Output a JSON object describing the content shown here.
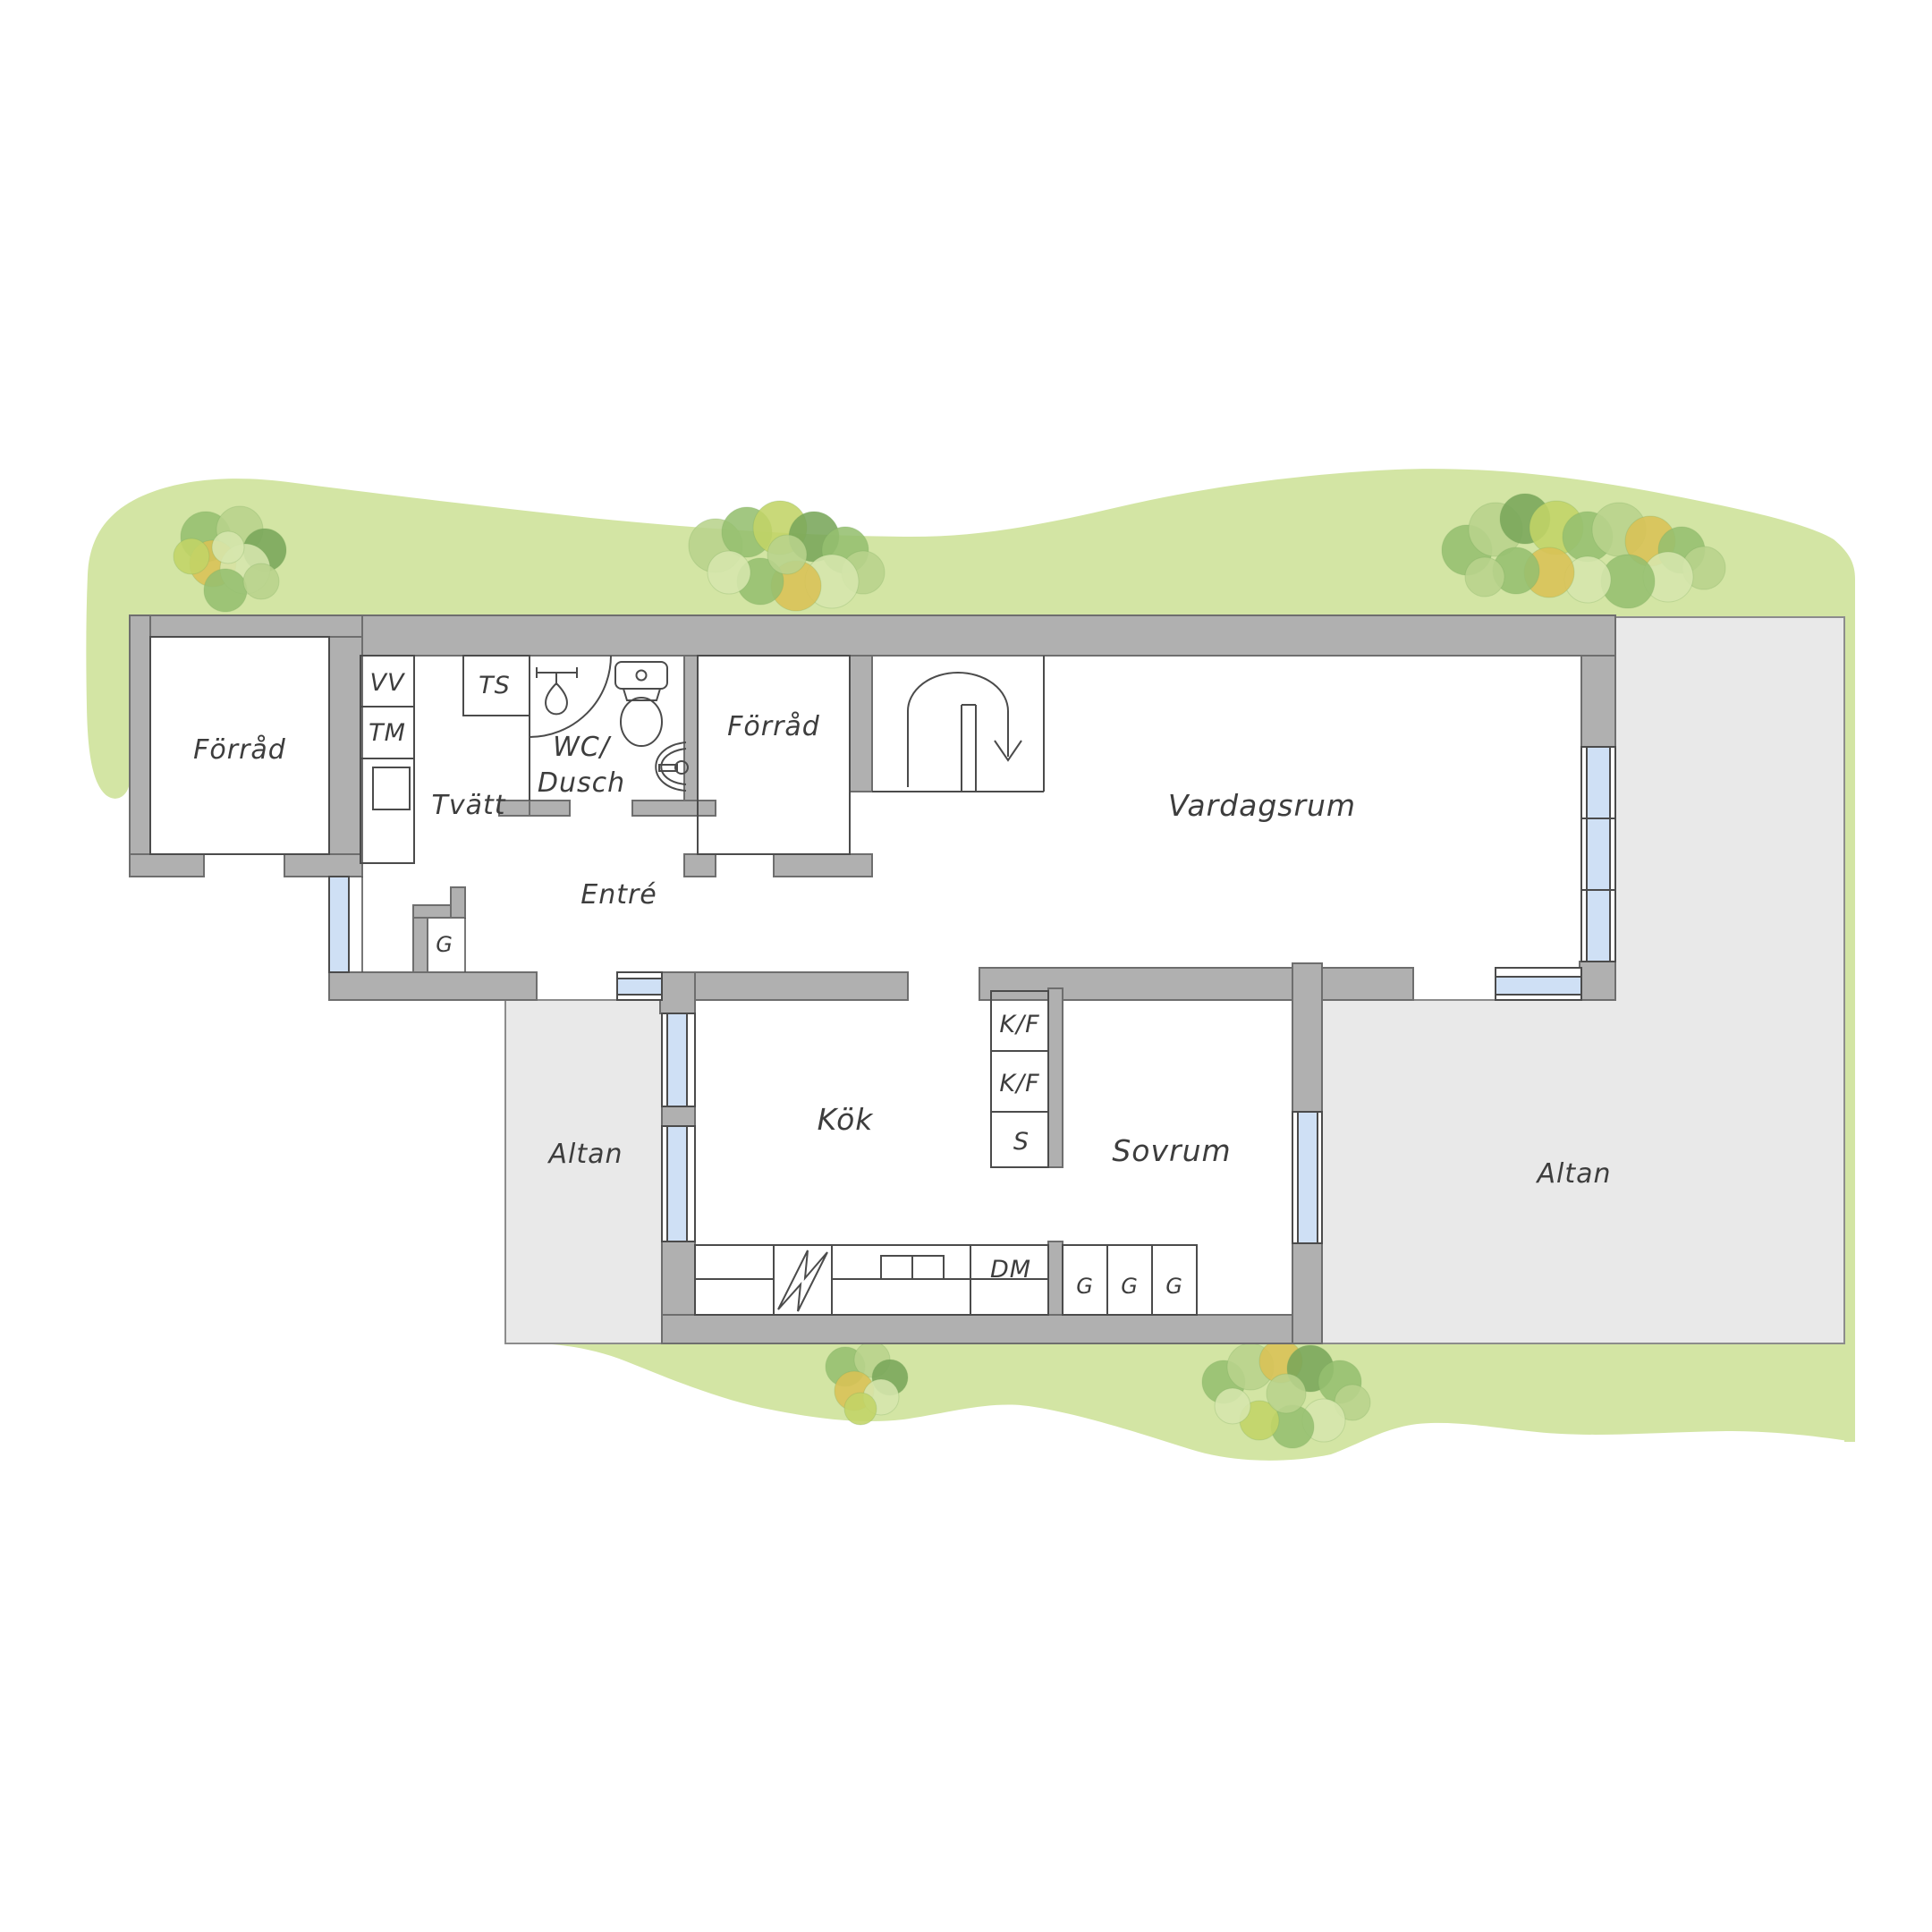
{
  "colors": {
    "lawn": "#d3e5a4",
    "wall_fill": "#b0b0b0",
    "wall_stroke": "#6e6e6e",
    "altan_fill": "#e9e9e9",
    "altan_stroke": "#8c8c8c",
    "glass": "#cfe0f5",
    "line": "#4b4b4b",
    "label": "#3d3d3d",
    "tree_dark": "#79a65a",
    "tree_mid": "#95bf70",
    "tree_light": "#b8d38c",
    "tree_pale": "#d6e6ad",
    "tree_yellow": "#d9c155",
    "tree_lime": "#c2d467"
  },
  "labels": {
    "annex_storage": "Förråd",
    "water_heater": "VV",
    "washing_machine": "TM",
    "drying_cabinet": "TS",
    "laundry": "Tvätt",
    "wc_line1": "WC/",
    "wc_line2": "Dusch",
    "inner_storage": "Förråd",
    "entrance": "Entré",
    "entry_wardrobe": "G",
    "living_room": "Vardagsrum",
    "kitchen": "Kök",
    "fridge_freezer_1": "K/F",
    "fridge_freezer_2": "K/F",
    "pantry": "S",
    "bedroom": "Sovrum",
    "dishwasher": "DM",
    "wardrobe_1": "G",
    "wardrobe_2": "G",
    "wardrobe_3": "G",
    "patio_left": "Altan",
    "patio_right": "Altan"
  }
}
